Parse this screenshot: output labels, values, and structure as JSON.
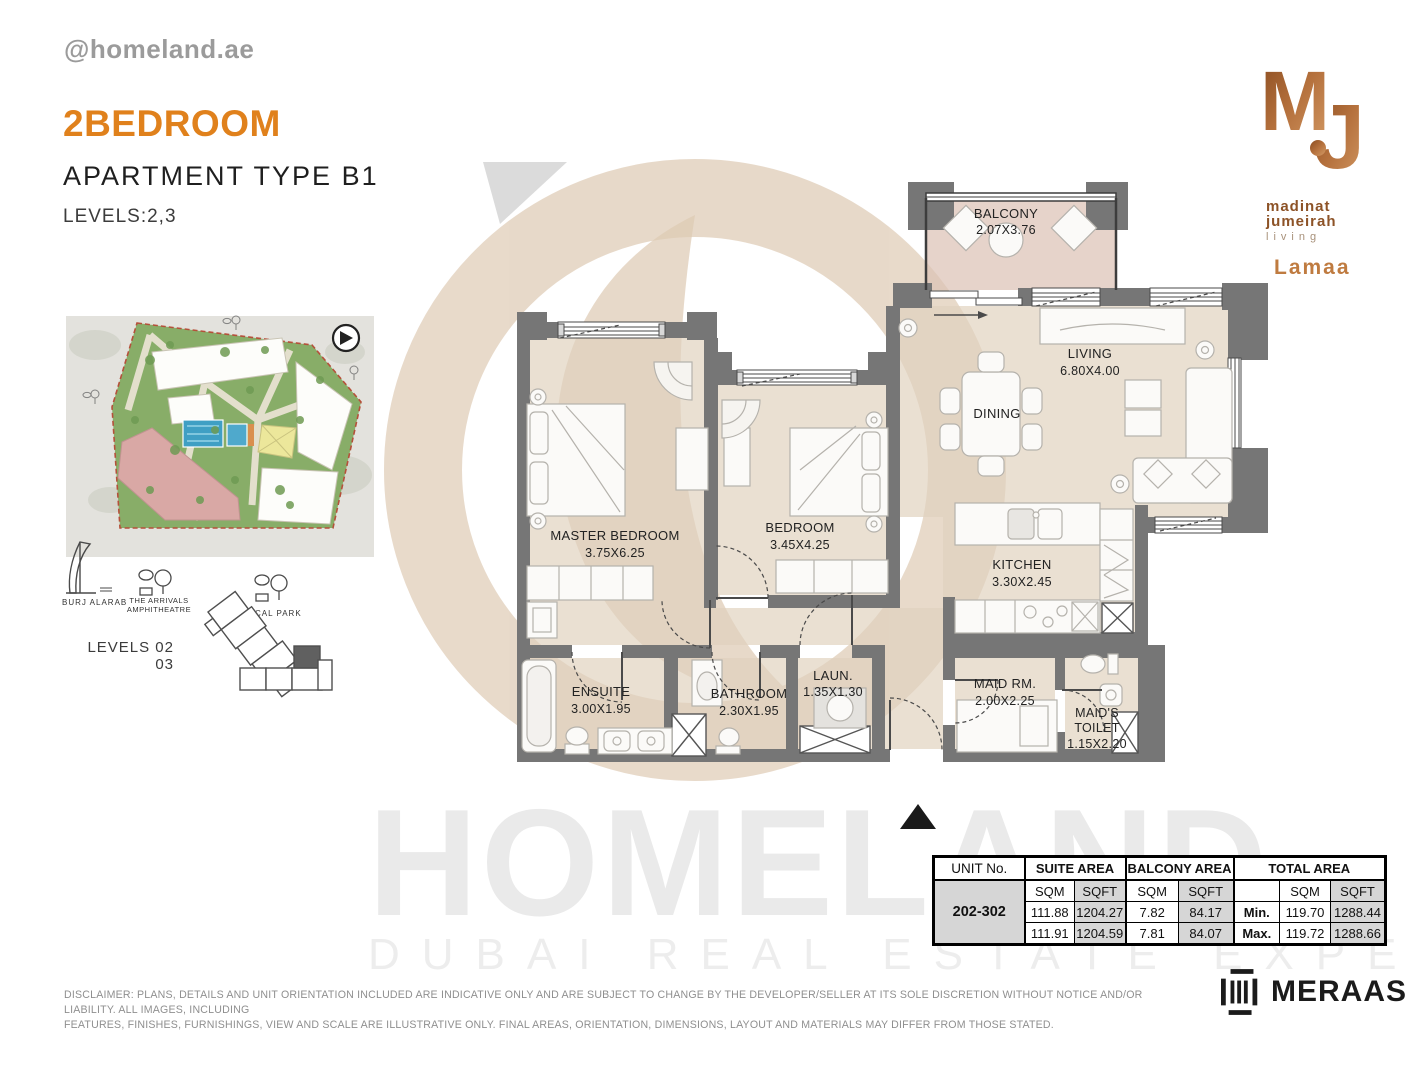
{
  "header": {
    "handle": "@homeland.ae",
    "title": "2BEDROOM",
    "subtitle": "APARTMENT TYPE B1",
    "levels": "LEVELS:2,3"
  },
  "brand": {
    "m": "M",
    "j": "J",
    "line1": "madinat",
    "line2": "jumeirah",
    "line3": "living",
    "project": "Lamaa"
  },
  "site": {
    "burj": "BURJ ALARAB",
    "arrivals1": "THE ARRIVALS",
    "arrivals2": "AMPHITHEATRE",
    "park": "LOCAL PARK",
    "levels1": "LEVELS 02",
    "levels2": "03"
  },
  "rooms": {
    "balcony": {
      "name": "BALCONY",
      "dims": "2.07X3.76"
    },
    "living": {
      "name": "LIVING",
      "dims": "6.80X4.00"
    },
    "dining": {
      "name": "DINING"
    },
    "master": {
      "name": "MASTER BEDROOM",
      "dims": "3.75X6.25"
    },
    "bedroom": {
      "name": "BEDROOM",
      "dims": "3.45X4.25"
    },
    "kitchen": {
      "name": "KITCHEN",
      "dims": "3.30X2.45"
    },
    "ensuite": {
      "name": "ENSUITE",
      "dims": "3.00X1.95"
    },
    "bathroom": {
      "name": "BATHROOM",
      "dims": "2.30X1.95"
    },
    "laundry": {
      "name": "LAUN.",
      "dims": "1.35X1.30"
    },
    "maid": {
      "name": "MAID RM.",
      "dims": "2.00X2.25"
    },
    "maid_toilet": {
      "name1": "MAID'S",
      "name2": "TOILET",
      "dims": "1.15X2.20"
    }
  },
  "table": {
    "unit_header": "UNIT No.",
    "group_suite": "SUITE AREA",
    "group_balcony": "BALCONY AREA",
    "group_total": "TOTAL AREA",
    "sqm": "SQM",
    "sqft": "SQFT",
    "unit": "202-302",
    "min_label": "Min.",
    "max_label": "Max.",
    "min_row": {
      "suite_sqm": "111.88",
      "suite_sqft": "1204.27",
      "balcony_sqm": "7.82",
      "balcony_sqft": "84.17",
      "total_sqm": "119.70",
      "total_sqft": "1288.44"
    },
    "max_row": {
      "suite_sqm": "111.91",
      "suite_sqft": "1204.59",
      "balcony_sqm": "7.81",
      "balcony_sqft": "84.07",
      "total_sqm": "119.72",
      "total_sqft": "1288.66"
    }
  },
  "watermark": {
    "name": "HOMELAND",
    "tagline": "DUBAI REAL ESTATE EXPERTS"
  },
  "disclaimer": {
    "line1": "DISCLAIMER: PLANS, DETAILS AND UNIT ORIENTATION INCLUDED ARE INDICATIVE ONLY AND ARE SUBJECT TO CHANGE BY THE DEVELOPER/SELLER AT ITS SOLE DISCRETION WITHOUT NOTICE AND/OR LIABILITY. ALL IMAGES, INCLUDING",
    "line2": "FEATURES, FINISHES, FURNISHINGS, VIEW AND SCALE ARE ILLUSTRATIVE ONLY. FINAL AREAS, ORIENTATION, DIMENSIONS, LAYOUT AND MATERIALS MAY DIFFER FROM THOSE STATED."
  },
  "footer": {
    "meraas": "MERAAS"
  },
  "colors": {
    "accent_orange": "#E0811C",
    "copper": "#B06E3B",
    "wall_gray": "#767676",
    "floor_beige": "#EAE0D2",
    "balcony_floor": "#E6D3CA",
    "site_green": "#88AD68",
    "site_pink": "#D9A8A5",
    "pool_blue": "#3F9FC4"
  }
}
